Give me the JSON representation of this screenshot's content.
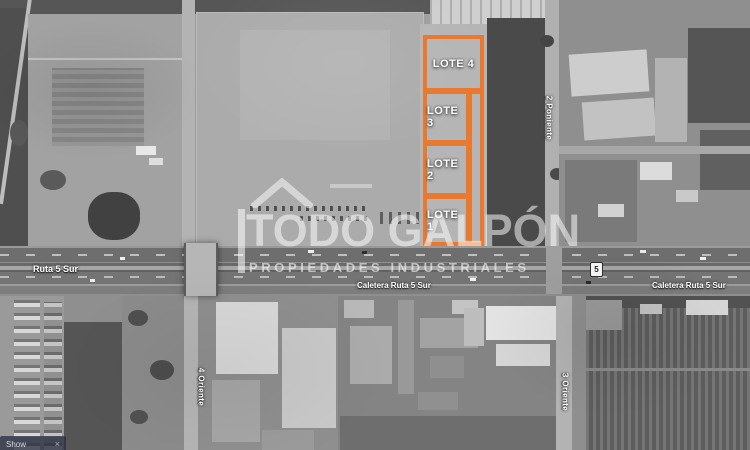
{
  "lots": [
    {
      "label": "LOTE 4"
    },
    {
      "label": "LOTE 3"
    },
    {
      "label": "LOTE 2"
    },
    {
      "label": "LOTE 1"
    }
  ],
  "roads": {
    "highway": "Ruta 5 Sur",
    "caletera": "Caletera Ruta 5 Sur",
    "oriente4": "4 Oriente",
    "oriente3": "3 Oriente",
    "poniente2": "2 Poniente",
    "shield": "5"
  },
  "watermark": {
    "title": "TODO GALPÓN",
    "subtitle": "PROPIEDADES INDUSTRIALES"
  },
  "overlay": {
    "label": "Show",
    "close": "×"
  },
  "colors": {
    "lot_accent": "#E8792E",
    "label_text": "#FFFFFF"
  }
}
